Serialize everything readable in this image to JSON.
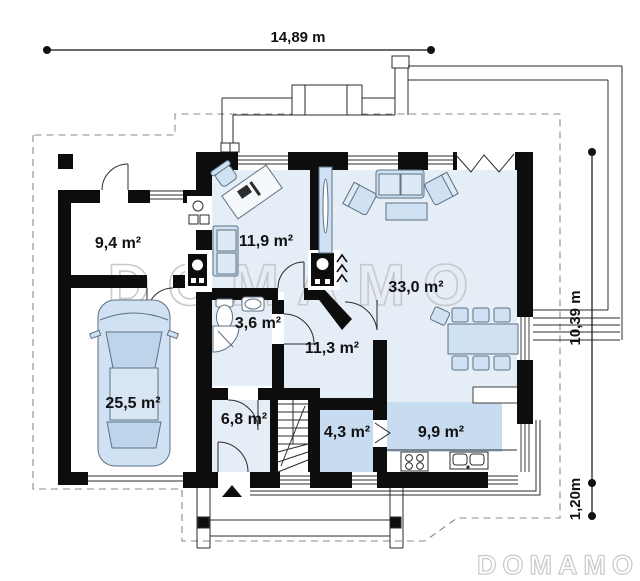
{
  "plan": {
    "dimensions": {
      "top": "14,89 m",
      "right": "10,39 m",
      "right_small": "1,20m"
    },
    "rooms": {
      "tech_room": "9,4 m²",
      "office": "11,9 m²",
      "living_room": "33,0 m²",
      "bathroom": "3,6 m²",
      "hall": "11,3 m²",
      "garage": "25,5 m²",
      "corridor": "6,8 m²",
      "pantry": "4,3 m²",
      "kitchen": "9,9 m²"
    },
    "watermark": {
      "center": "DOMAMO",
      "corner": "DOMAMO"
    },
    "colors": {
      "wall": "#0d0d0d",
      "floor_light": "#e5edf6",
      "floor_medium": "#c7dcf0",
      "furniture_fill": "#cfe1f2",
      "furniture_stroke": "#5d7183",
      "watermark": "#c9c9c9"
    }
  }
}
